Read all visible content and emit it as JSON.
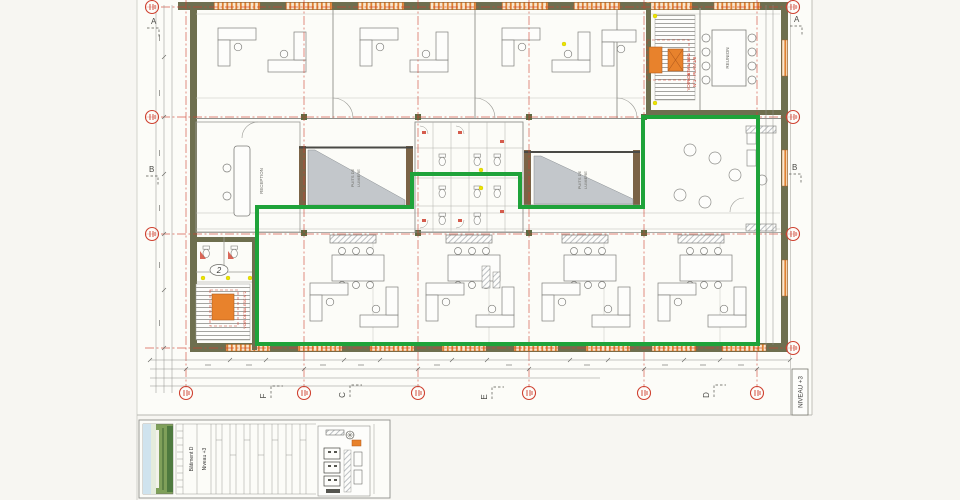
{
  "labels": {
    "reception": "RECEPTION",
    "reunion": "REUNION",
    "light_well_line1": "PUITS DE",
    "light_well_line2": "LUMIERE",
    "level_box": "NIVEAU +3",
    "elevator": "2",
    "stair_detail_line1": "VOIR DETAIL ESC",
    "stair_detail_line2": "N°1 - PLAN 1/8",
    "stair_detail_left": "VOIR DETAIL ESC N°2"
  },
  "grid_letters": {
    "a": "A",
    "b": "B",
    "f": "F",
    "c": "C",
    "e": "E",
    "d": "D"
  },
  "title_block": {
    "building": "Bâtiment D",
    "level": "Niveau +3"
  },
  "colors": {
    "highlight_green": "#1fa33a",
    "highlight_orange": "#e8822c",
    "grid_red": "#cf4130",
    "wall_olive": "#6e6f4f",
    "hatch_triangle": "#c3c7cb"
  }
}
